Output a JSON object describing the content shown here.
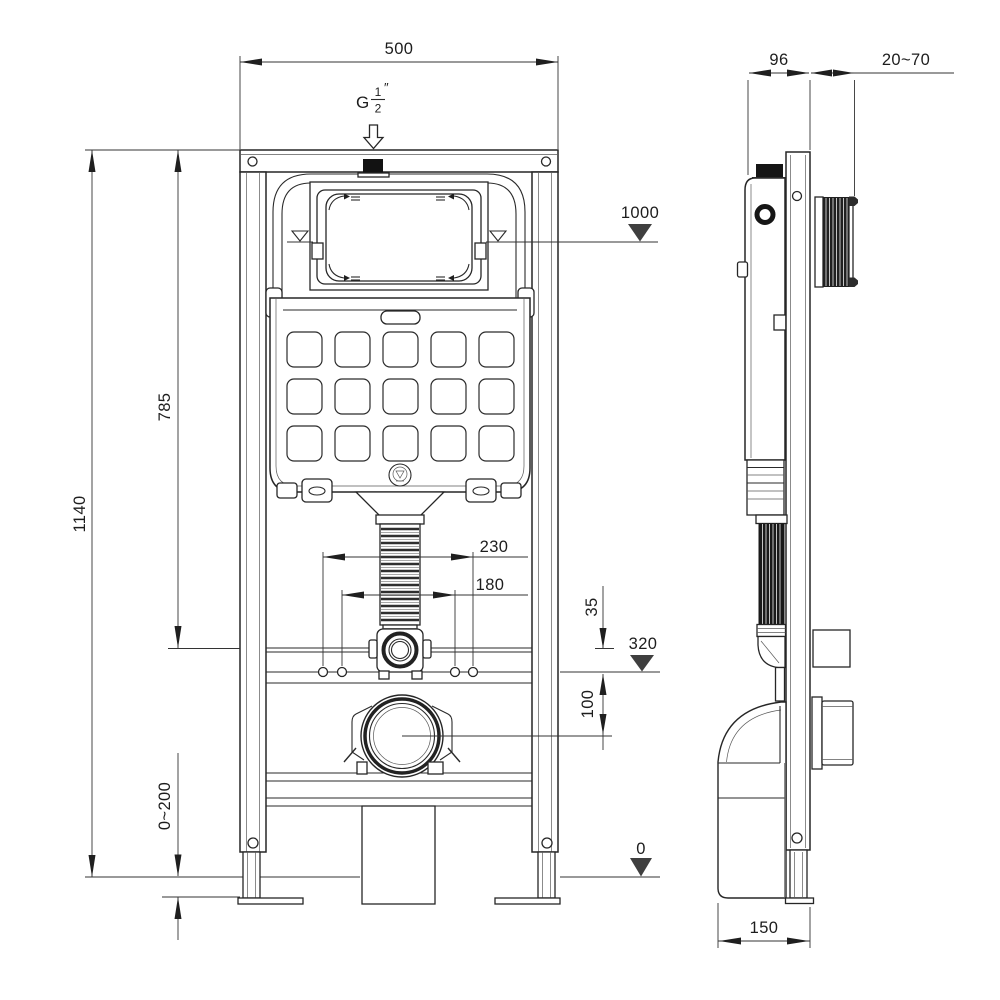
{
  "front_view": {
    "width_label": "500",
    "inlet_thread": {
      "prefix": "G",
      "numerator": "1",
      "denominator": "2",
      "inch_mark": "″"
    },
    "datum_top": "1000",
    "datum_mid": "320",
    "datum_floor": "0",
    "height_overall": "1140",
    "height_cistern": "785",
    "foot_adjust_range": "0~200",
    "fixing_spacing_outer": "230",
    "fixing_spacing_inner": "180",
    "offset_rail_to_fixings": "35",
    "fixings_to_outlet_drop": "100"
  },
  "side_view": {
    "frame_depth": "96",
    "wall_distance_range": "20~70",
    "outlet_depth": "150"
  },
  "colors": {
    "line": "#2a2a2a",
    "background": "#ffffff",
    "datum_fill": "#3f3f3f"
  }
}
